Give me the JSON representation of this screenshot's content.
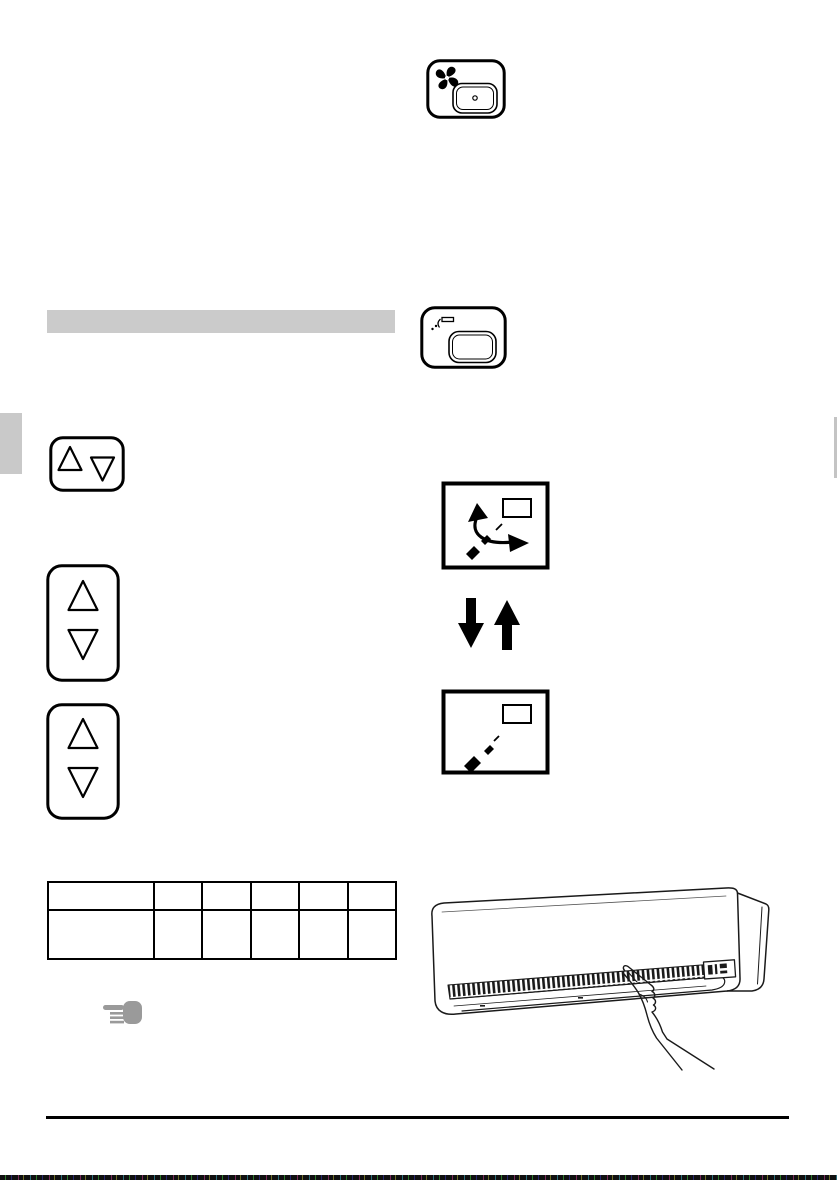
{
  "page": {
    "kind": "air-conditioner-operation-manual-page",
    "background": "#ffffff"
  },
  "colors": {
    "line_art": "#000000",
    "section_bar_gray": "#cbcbcb",
    "edge_tab_gray": "#c9c9c9",
    "hand_note_gray": "#9a9a9a",
    "noise_strip": "#101010"
  },
  "section_header_bar": {
    "text": ""
  },
  "remote_buttons": {
    "fan_button": {
      "icon": "fan-blades-icon",
      "label": ""
    },
    "swing_button": {
      "icon": "swing-louver-icon",
      "label": ""
    },
    "temp_updown_button": {
      "icons": [
        "triangle-up-icon",
        "triangle-down-icon"
      ],
      "label": ""
    },
    "updown_button_1": {
      "icons": [
        "triangle-up-icon",
        "triangle-down-icon"
      ],
      "label": ""
    },
    "updown_button_2": {
      "icons": [
        "triangle-up-icon",
        "triangle-down-icon"
      ],
      "label": ""
    }
  },
  "indicators": {
    "swing_flap_box": {
      "icons": [
        "louver-rect-icon",
        "swing-arc-arrow-icon",
        "dashed-flap-icon"
      ]
    },
    "direction_arrows": {
      "icons": [
        "arrow-down-icon",
        "arrow-up-icon"
      ]
    },
    "fixed_flap_box": {
      "icons": [
        "louver-rect-icon",
        "dashed-flap-icon"
      ]
    }
  },
  "table": {
    "columns": 6,
    "rows": 2,
    "cells": [
      [
        "",
        "",
        "",
        "",
        "",
        ""
      ],
      [
        "",
        "",
        "",
        "",
        "",
        ""
      ]
    ]
  },
  "note": {
    "icon": "pointing-hand-icon",
    "text": ""
  },
  "illustration": {
    "name": "wall-mounted-indoor-unit-with-hand",
    "elements": [
      "indoor-unit-body",
      "louver-grille",
      "display-panel",
      "pointing-hand-arm"
    ]
  }
}
